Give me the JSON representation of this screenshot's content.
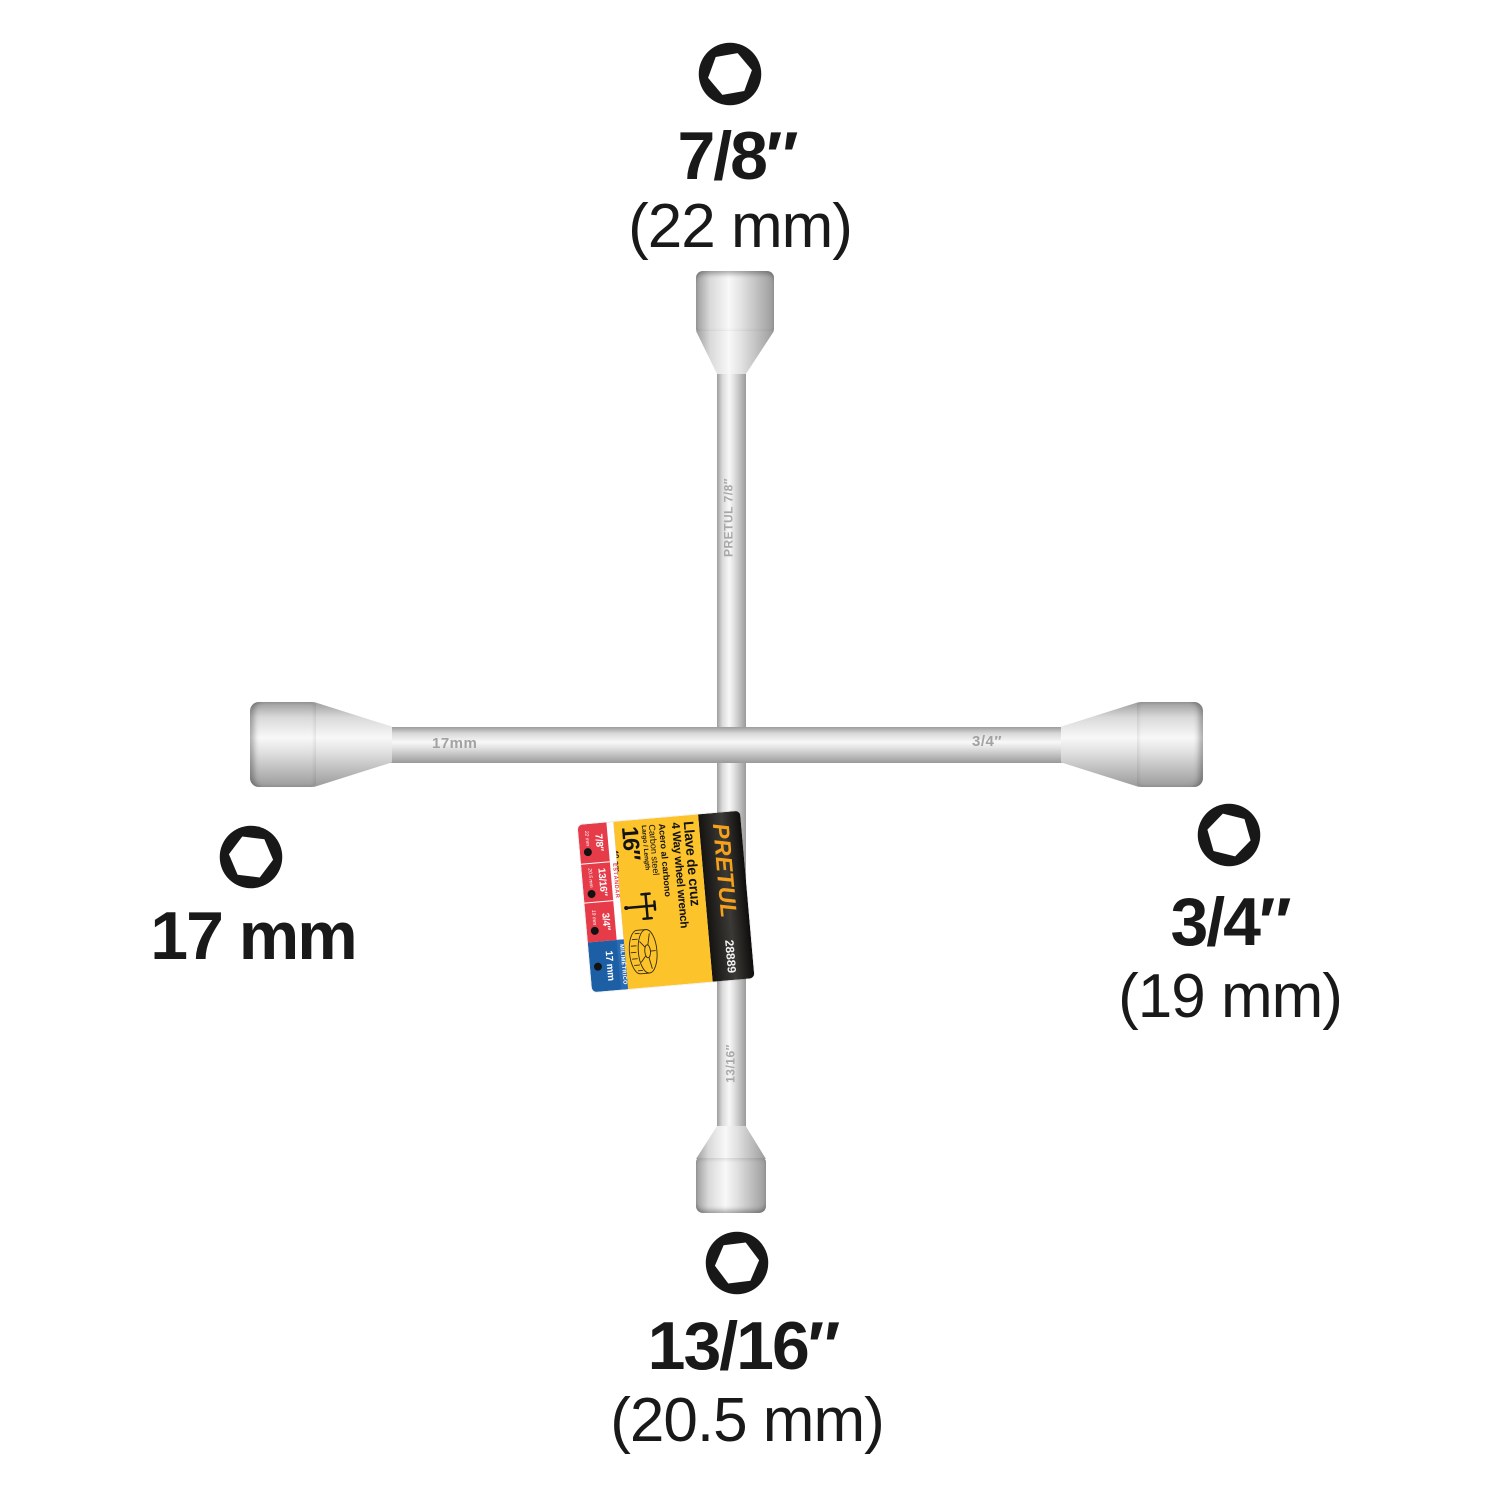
{
  "callouts": {
    "top": {
      "size": "7/8″",
      "metric": "(22 mm)"
    },
    "left": {
      "size": "17 mm"
    },
    "right": {
      "size": "3/4″",
      "metric": "(19 mm)"
    },
    "bottom": {
      "size": "13/16″",
      "metric": "(20.5 mm)"
    }
  },
  "engravings": {
    "left_arm": "17mm",
    "right_arm": "3/4″",
    "upper_shaft": "PRETUL   7/8″",
    "lower_shaft": "13/16″"
  },
  "tag": {
    "brand": "PRETUL",
    "sku": "28889",
    "title_es": "Llave de cruz",
    "title_en": "4 Way wheel wrench",
    "material_es": "Acero al carbono",
    "material_en": "Carbon steel",
    "length_label": "Largo / Length",
    "length_value": "16″",
    "length_metric": "40 cm",
    "standard_header": "ESTÁNDAR",
    "metric_header": "MILIMÉTRICO",
    "standard_sizes": [
      {
        "size": "7/8″",
        "mm": "22 mm"
      },
      {
        "size": "13/16″",
        "mm": "20.5 mm"
      },
      {
        "size": "3/4″",
        "mm": "19 mm"
      }
    ],
    "metric_size": {
      "size": "17 mm"
    },
    "colors": {
      "yellow": "#fcc32a",
      "red": "#e63c4a",
      "blue": "#1c5fa5",
      "black": "#1b1917",
      "brand_orange": "#f6a11c"
    }
  }
}
